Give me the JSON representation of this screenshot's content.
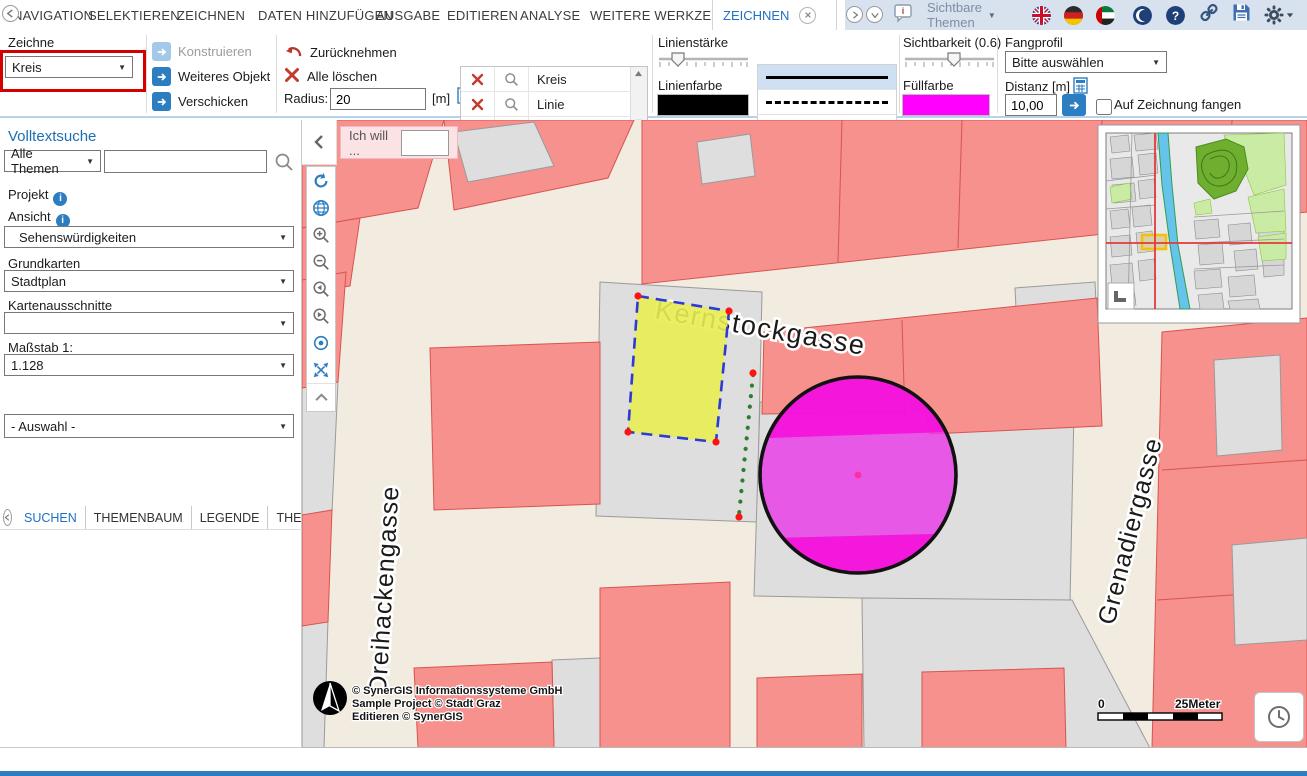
{
  "menu": {
    "items": [
      "NAVIGATION",
      "SELEKTIEREN",
      "ZEICHNEN",
      "DATEN HINZUFÜGEN",
      "AUSGABE",
      "EDITIEREN",
      "ANALYSE",
      "WEITERE WERKZEUGE"
    ],
    "active_tab": "ZEICHNEN",
    "themes_label": "Sichtbare Themen"
  },
  "icons": {
    "top_right": [
      "speech-bubble-info",
      "flag-en",
      "flag-de",
      "flag-ae",
      "crescent-moon",
      "help",
      "link",
      "save",
      "settings",
      "power",
      "collapse-up"
    ],
    "map_tools": [
      "refresh",
      "globe",
      "zoom-in",
      "zoom-out",
      "zoom-previous",
      "zoom-next",
      "center-point",
      "full-extent",
      "collapse-up"
    ]
  },
  "toolbar": {
    "zeichne_label": "Zeichne",
    "zeichne_value": "Kreis",
    "konstruieren": "Konstruieren",
    "weiteres_objekt": "Weiteres Objekt",
    "verschicken": "Verschicken",
    "zuruecknehmen": "Zurücknehmen",
    "alle_loeschen": "Alle löschen",
    "radius_label": "Radius:",
    "radius_value": "20",
    "radius_unit": "[m]",
    "objects": [
      {
        "label": "Kreis"
      },
      {
        "label": "Linie"
      },
      {
        "label": ""
      }
    ],
    "linienstaerke_label": "Linienstärke",
    "linienfarbe_label": "Linienfarbe",
    "linienfarbe_hex": "#000000",
    "styles": [
      "solid",
      "dashed",
      "dotted"
    ],
    "sichtbarkeit_label": "Sichtbarkeit (0.6)",
    "fuellfarbe_label": "Füllfarbe",
    "fuellfarbe_hex": "#ff00ff",
    "fangprofil_label": "Fangprofil",
    "fangprofil_value": "Bitte auswählen",
    "distanz_label": "Distanz [m]",
    "distanz_value": "10,00",
    "snap_label": "Auf Zeichnung fangen"
  },
  "sidebar": {
    "volltextsuche_label": "Volltextsuche",
    "theme_filter_value": "Alle Themen",
    "search_value": "",
    "projekt_label": "Projekt",
    "ansicht_label": "Ansicht",
    "ansicht_value": "Sehenswürdigkeiten",
    "grundkarten_label": "Grundkarten",
    "grundkarten_value": "Stadtplan",
    "kartenausschnitte_label": "Kartenausschnitte",
    "kartenausschnitte_value": "",
    "massstab_label": "Maßstab 1:",
    "massstab_value": "1.128",
    "tabs": [
      "SUCHEN",
      "THEMENBAUM",
      "LEGENDE",
      "THEM"
    ],
    "auswahl_value": "- Auswahl -"
  },
  "map": {
    "ich_will_label": "Ich will ...",
    "streets": {
      "kernstock": "Kernstockgasse",
      "dreihacken": "Dreihackengasse",
      "grenadier": "Grenadiergasse"
    },
    "copyright": [
      "© SynerGIS Informationssysteme GmbH",
      "Sample Project © Stadt Graz",
      "Editieren © SynerGIS"
    ],
    "scalebar": {
      "zero": "0",
      "label": "25Meter"
    }
  },
  "colors": {
    "accent": "#2d7dc1",
    "salmon_building": "#f6918e",
    "map_background": "#f1ecdf",
    "drawing_fill": "#ff00ff",
    "drawing_yellow": "#e9ed53",
    "annotation_red": "#d40000"
  }
}
